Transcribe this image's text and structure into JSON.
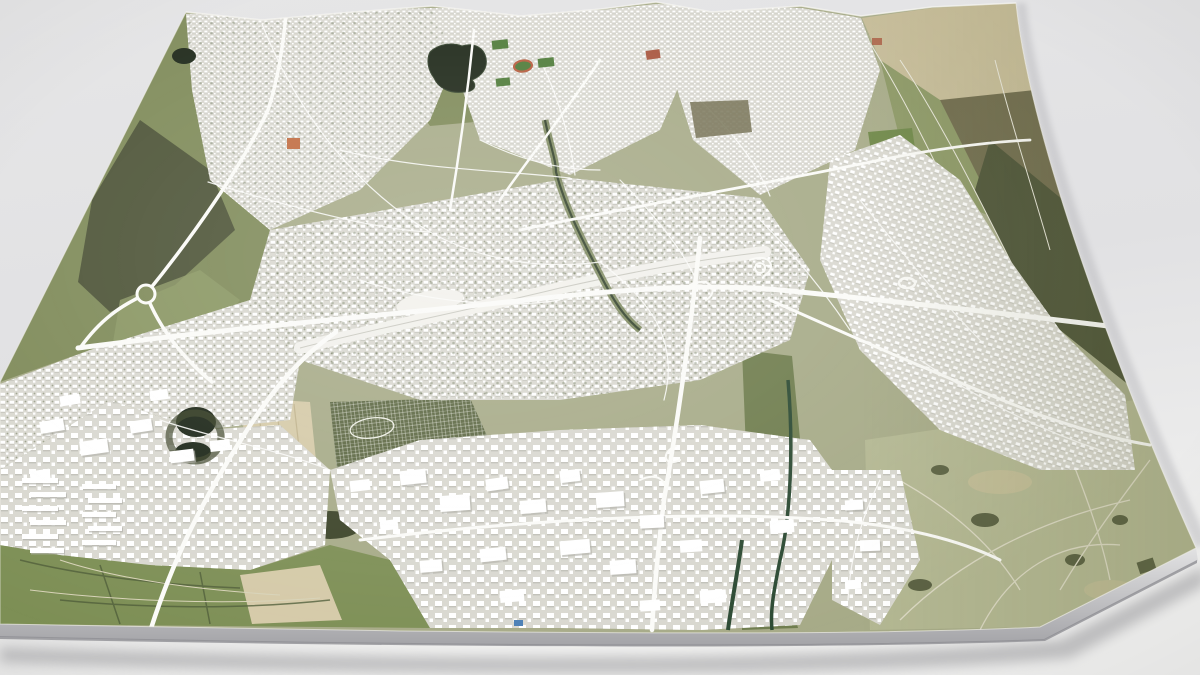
{
  "scene": {
    "title": "3D aerial model of a city map on a light grey surface",
    "type": "aerial-3d-city-map",
    "perspective": "tilted slab, far edge at top, thin slab side and soft shadow at bottom",
    "no_text_visible": true
  },
  "palette": {
    "bg_top": "#e6e6e7",
    "bg_mid": "#e1e1e3",
    "bg_bottom": "#f0f0ef",
    "slab_top": "#e2e2e3",
    "slab_bottom": "#a4a4a8",
    "slab_lip": "#8f8f93",
    "shadow": "#8e8e92",
    "edge_shadow": "#b5b5b9",
    "base": "#a7ab88",
    "city": "#d9d8d0",
    "building": "#ffffff",
    "building_shadow": "#b0b0a8",
    "road": "#fbfbf8",
    "rail": "#f2f1ec",
    "rail_line": "#c9c9c0",
    "park": "#7e8a58",
    "corridor": "#6f7d4e",
    "field_tan": "#c6bc98",
    "field_wheat": "#d5caa8",
    "field_green": "#8c9865",
    "field_bright": "#6e8747",
    "field_dark": "#6f6b4c",
    "wood": "#4c5336",
    "wood_dark": "#3c4429",
    "meadow": "#b4b893",
    "meadow_path": "#dcd9c4",
    "meadow_tan": "#c2bd97",
    "farm": "#7d8f55",
    "farm_lane": "#d8d3b8",
    "hedge": "#4f5c38",
    "allotment": "#5c6742",
    "allotment_line": "#eff0e6",
    "water": "#1c2617",
    "water_edge": "#31402a",
    "canal": "#2c4a33",
    "river_band": "#6e7c4e",
    "sport_green": "#4d7a37",
    "track_red": "#b55a3b",
    "roof_red": "#a8543c",
    "roof_orange": "#c06a3f",
    "blue_building": "#4a7fb5",
    "east_shade": "#63673f",
    "field_line": "#e9e7da",
    "highlight": "#ffffff"
  },
  "features": {
    "water": [
      "lake",
      "pond-northwest",
      "twin-ponds-west",
      "river-center",
      "canal-east",
      "canal-south"
    ],
    "rail": [
      "railway-corridor",
      "central-station-yard"
    ],
    "roads": [
      "motorway-east-west",
      "motorway-north-south",
      "motorway-southwest",
      "ring-road-northwest",
      "radial-streets",
      "roundabout-west",
      "interchange-east",
      "interchange-south"
    ],
    "districts": [
      "northwest-district",
      "north-district",
      "northeast-suburb",
      "east-suburb",
      "city-center",
      "west-industrial",
      "southwest-industrial",
      "south-industrial",
      "southeast-industrial-strip",
      "housing-estate-southwest",
      "allotment-gardens"
    ],
    "landuse": [
      "northwest-woodland",
      "lakeside-park",
      "northeast-fields",
      "northeast-woodland",
      "southeast-meadows",
      "southwest-farmland",
      "central-tilled-field"
    ],
    "landmarks": [
      "running-track-stadium",
      "sports-fields",
      "red-roof-complex",
      "orange-brick-building",
      "blue-building"
    ]
  }
}
